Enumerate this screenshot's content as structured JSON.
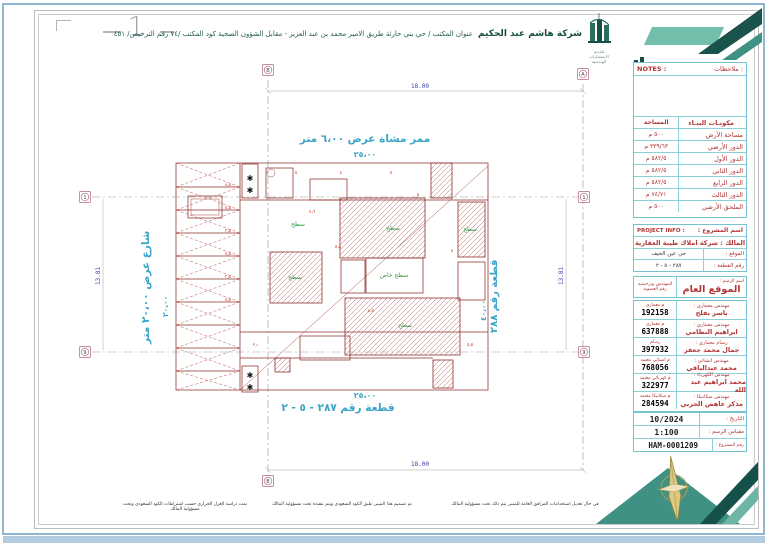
{
  "colors": {
    "brand_teal": "#1a524c",
    "teal_light": "#74bfab",
    "cyan_border": "#76c3d2",
    "label_red": "#b23535",
    "plan_red": "#8e2f2a",
    "plan_cyan": "#3aa4c8",
    "dim_blue": "#3c3cae",
    "compass_gold": "#ddc87f"
  },
  "icons": {
    "logo": "company-building-logo",
    "logo_small": "company-building-logo-small",
    "compass": "north-compass",
    "tree": "tree-symbol"
  },
  "sheet": {
    "fold_number": "1",
    "header": {
      "company_name": "شركة هاشم عبد الحكيم",
      "company_address": "عنوان المكتب / حي بني حارثة طريق الامير محمد بن عبد العزيز - مقابل الشؤون الصحية  كود المكتب /٧٤  رقم الترخيص/ ٤٥١",
      "logo_caption": "لتقديم الاستشارات الهندسية"
    },
    "footer_notes": [
      "تمت دراسة العزل الحراري حسب اشتراطات الكود السعودي وتحت مسؤولية المالك",
      "تم تصميم هذا المبنى طبق الكود السعودي ويتم تنفيذه تحت مسؤولية المالك",
      "في حال تعديل استخدامات المرافق العامة للمبنى يتم ذلك تحت مسؤولية المالك"
    ]
  },
  "title_block": {
    "notes": {
      "en": "NOTES :",
      "ar": "ملاحظات :"
    },
    "components": {
      "header_area": "المساحة",
      "header_component": "مكونـات البنـاء",
      "rows": [
        {
          "name": "مساحة الأرض",
          "area": "٥٠٠ م"
        },
        {
          "name": "الدور الأرضي",
          "area": "٣٣٩/٦٣ م"
        },
        {
          "name": "الدور الأول",
          "area": "٥٨٢/٥ م"
        },
        {
          "name": "الدور الثاني",
          "area": "٥٨٢/٥ م"
        },
        {
          "name": "الدور الرابع",
          "area": "٥٨٢/٥ م"
        },
        {
          "name": "الدور الثالث",
          "area": "٧٤/٧١ م"
        },
        {
          "name": "الملحق الأرضي",
          "area": "٥٠٠ م"
        }
      ]
    },
    "project": {
      "header_ar": "اسم المشروع :",
      "header_en": "PROJECT INFO :",
      "owner": "المالك : شركة املاك طيبة العقارية",
      "location_label": "الموقع :",
      "location_value": "حي عين الخيف",
      "plot_label": "رقم القطعة :",
      "plot_value": "٢٨٧ - ٥ - ٢"
    },
    "sheet_name": {
      "label": "اسم الرسم :",
      "value": "الموقع العام",
      "eng_col_line1": "المهندس وترخيصه",
      "eng_col_line2": "رقم العضوية"
    },
    "engineers": [
      {
        "role": "مهندس معماري :",
        "name": "ياسر بفلح",
        "lic": "م معماري",
        "num": "192158"
      },
      {
        "role": "مهندس معماري :",
        "name": "ابراهيم النظامي",
        "lic": "م معماري",
        "num": "637888"
      },
      {
        "role": "رسام معماري :",
        "name": "جمال محمد جعفر",
        "lic": "رسام",
        "num": "397932"
      },
      {
        "role": "مهندس انشائي :",
        "name": "محمد عبدالباقي",
        "lic": "م انشائي معتمد",
        "num": "768056"
      },
      {
        "role": "مهندس الكهرباء :",
        "name": "محمد ابراهيم عبد الله",
        "lic": "م كهربائي معتمد",
        "num": "322977"
      },
      {
        "role": "مهندس ميكانيكا :",
        "name": "مذكر عاهض الحربي",
        "lic": "م ميكانيكا معتمد",
        "num": "284594"
      }
    ],
    "meta": {
      "date_label": "التاريخ :",
      "date_value": "10/2024",
      "scale_label": "مقياس الرسم :",
      "scale_value": "1:100",
      "project_no_label": "رقم المشروع :",
      "project_no_value": "HAM-0001209"
    }
  },
  "plan": {
    "walkway_label": "ممر مشاة عرض ٦،٠٠ متر",
    "walkway_dim": "٢٥،٠٠",
    "street_label": "شارع عرض ٢٠،٠٠ متر",
    "street_dim": "٢٠،٠٠",
    "plot_right_label": "قطعة رقم ٢٨٨",
    "plot_right_dim": "٤٠،٠٠",
    "plot_bottom_label": "قطعة رقم ٢٨٧ - ٥ - ٢",
    "plot_bottom_dim": "٢٥،٠٠",
    "grid": {
      "col_left": "B",
      "col_right": "A",
      "row_top": "1",
      "row_bottom": "9",
      "width_dim": "18.00",
      "height_dim": "13.81"
    },
    "green_labels": [
      "سطح",
      "سطح",
      "سطح خاص",
      "سطح",
      "سطح",
      "سطح"
    ],
    "micro_dims": [
      "٨٫٨",
      "٥٫٥",
      "٣٫٥",
      "٥٫٥",
      "٣٫٥",
      "٥٫٥",
      "٥",
      "٤",
      "٥",
      "٧٫٦",
      "٥٫٨",
      "٤٫٥",
      "٥",
      "٢٫٠",
      "٥٫٥",
      "٥"
    ],
    "tree_symbol": "✱"
  }
}
